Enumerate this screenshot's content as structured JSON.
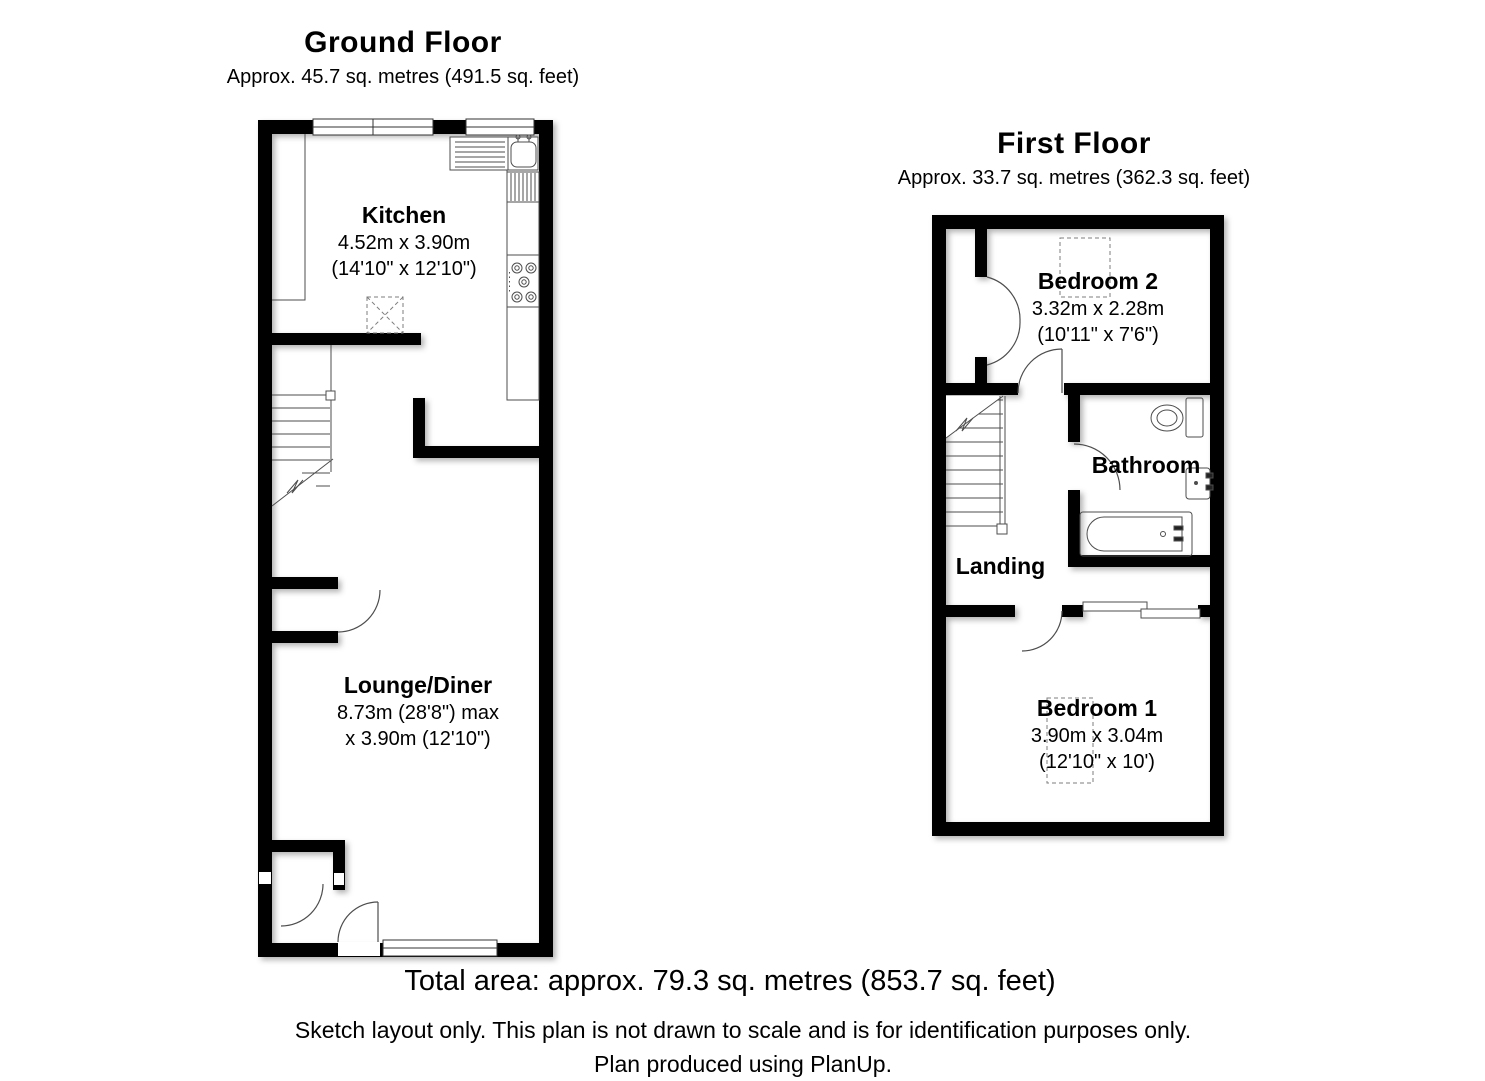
{
  "ground_floor": {
    "title": "Ground Floor",
    "area": "Approx.  45.7 sq. metres (491.5 sq. feet)",
    "rooms": {
      "kitchen": {
        "name": "Kitchen",
        "dims1": "4.52m x 3.90m",
        "dims2": "(14'10\" x 12'10\")"
      },
      "lounge_diner": {
        "name": "Lounge/Diner",
        "dims1": "8.73m (28'8\") max",
        "dims2": "x 3.90m (12'10\")"
      }
    }
  },
  "first_floor": {
    "title": "First Floor",
    "area": "Approx.  33.7 sq. metres (362.3 sq. feet)",
    "rooms": {
      "bedroom2": {
        "name": "Bedroom 2",
        "dims1": "3.32m x 2.28m",
        "dims2": "(10'11\" x 7'6\")"
      },
      "bathroom": {
        "name": "Bathroom"
      },
      "landing": {
        "name": "Landing"
      },
      "bedroom1": {
        "name": "Bedroom 1",
        "dims1": "3.90m x 3.04m",
        "dims2": "(12'10\" x 10')"
      }
    }
  },
  "footer": {
    "total_area": "Total area: approx.  79.3 sq. metres (853.7 sq. feet)",
    "disclaimer": "Sketch layout only. This plan is not drawn to scale and is for identification purposes only.",
    "credit": "Plan produced using PlanUp."
  },
  "colors": {
    "wall": "#000000",
    "line": "#4d4d4d",
    "dash": "#7d7d7d"
  }
}
